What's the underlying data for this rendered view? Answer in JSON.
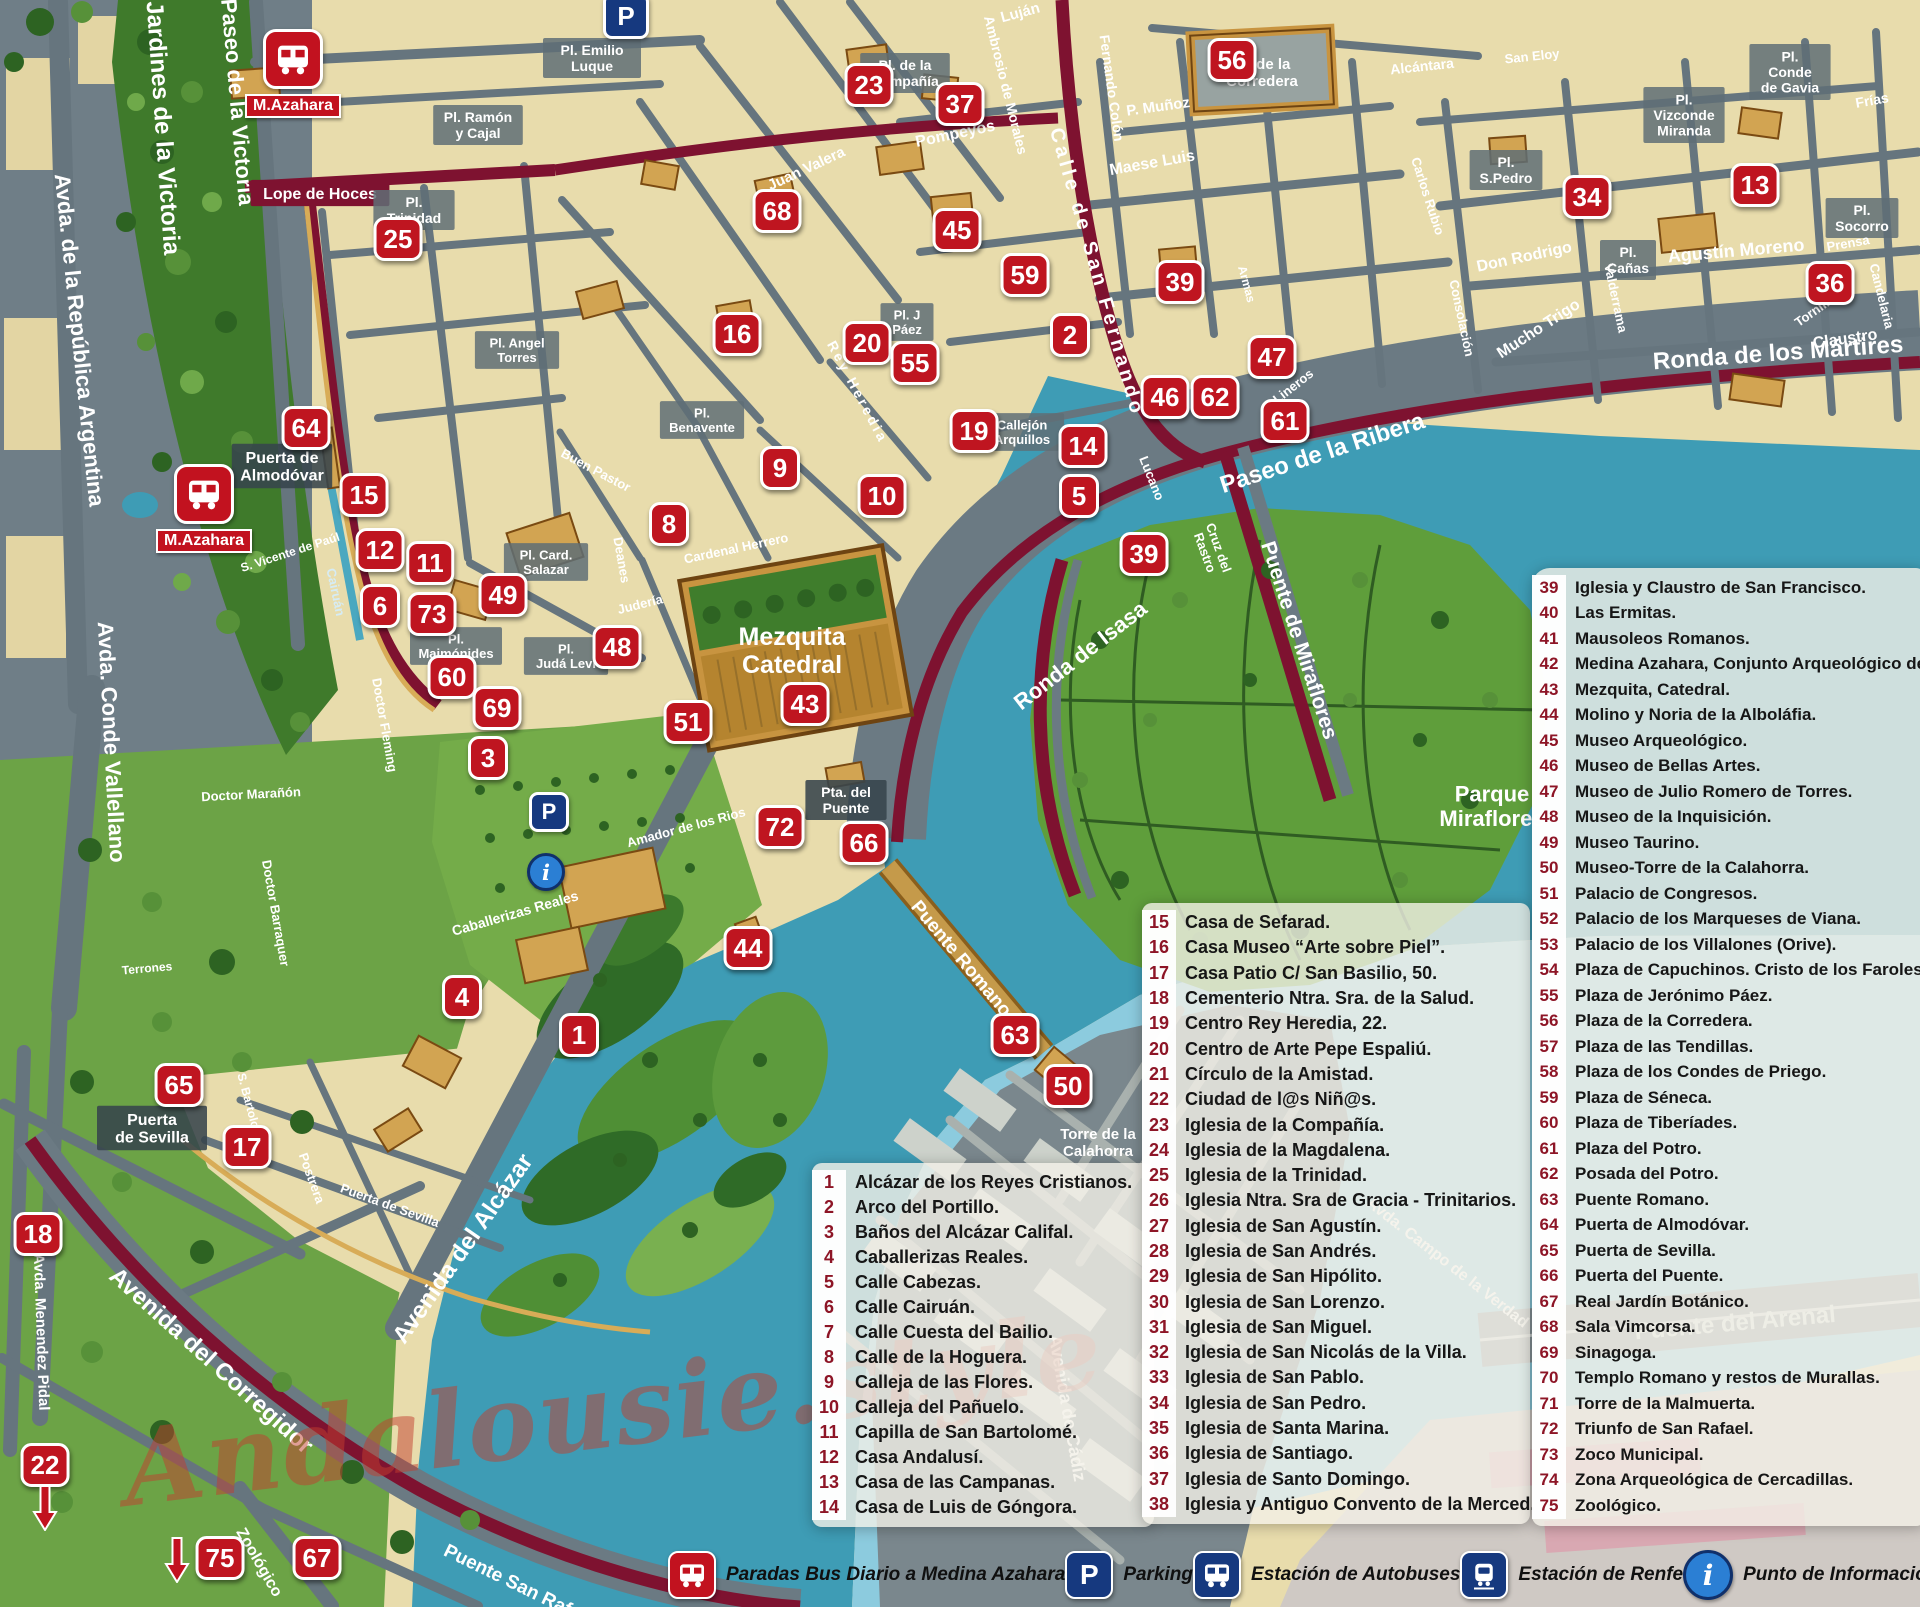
{
  "watermark": "Andalousie.style",
  "colors": {
    "marker_red": "#BF1520",
    "route_maroon": "#7E1230",
    "water": "#3E9CB5",
    "park_green": "#5F9E3B",
    "road_gray": "#66757E",
    "old_town_cream": "#E8DCAC",
    "legend_number": "#8D1526",
    "key_blue": "#16397F"
  },
  "legend1": {
    "items": [
      {
        "n": "1",
        "t": "Alcázar de los Reyes Cristianos."
      },
      {
        "n": "2",
        "t": "Arco del Portillo."
      },
      {
        "n": "3",
        "t": "Baños del Alcázar Califal."
      },
      {
        "n": "4",
        "t": "Caballerizas Reales."
      },
      {
        "n": "5",
        "t": "Calle Cabezas."
      },
      {
        "n": "6",
        "t": "Calle Cairuán."
      },
      {
        "n": "7",
        "t": "Calle Cuesta del Bailio."
      },
      {
        "n": "8",
        "t": "Calle de la Hoguera."
      },
      {
        "n": "9",
        "t": "Calleja de las Flores."
      },
      {
        "n": "10",
        "t": "Calleja del Pañuelo."
      },
      {
        "n": "11",
        "t": "Capilla de San Bartolomé."
      },
      {
        "n": "12",
        "t": "Casa Andalusí."
      },
      {
        "n": "13",
        "t": "Casa de las Campanas."
      },
      {
        "n": "14",
        "t": "Casa de Luis de Góngora."
      }
    ]
  },
  "legend2": {
    "items": [
      {
        "n": "15",
        "t": "Casa de Sefarad."
      },
      {
        "n": "16",
        "t": "Casa Museo “Arte sobre Piel”."
      },
      {
        "n": "17",
        "t": "Casa Patio C/ San Basilio, 50."
      },
      {
        "n": "18",
        "t": "Cementerio Ntra. Sra. de la Salud."
      },
      {
        "n": "19",
        "t": "Centro Rey Heredia, 22."
      },
      {
        "n": "20",
        "t": "Centro de Arte Pepe Espaliú."
      },
      {
        "n": "21",
        "t": "Círculo de la Amistad."
      },
      {
        "n": "22",
        "t": "Ciudad de l@s Niñ@s."
      },
      {
        "n": "23",
        "t": "Iglesia de la Compañía."
      },
      {
        "n": "24",
        "t": "Iglesia de la Magdalena."
      },
      {
        "n": "25",
        "t": "Iglesia de la Trinidad."
      },
      {
        "n": "26",
        "t": "Iglesia Ntra. Sra de Gracia - Trinitarios."
      },
      {
        "n": "27",
        "t": "Iglesia de San Agustín."
      },
      {
        "n": "28",
        "t": "Iglesia de San Andrés."
      },
      {
        "n": "29",
        "t": "Iglesia de San Hipólito."
      },
      {
        "n": "30",
        "t": "Iglesia de San Lorenzo."
      },
      {
        "n": "31",
        "t": "Iglesia de San Miguel."
      },
      {
        "n": "32",
        "t": "Iglesia de San Nicolás de la Villa."
      },
      {
        "n": "33",
        "t": "Iglesia de San Pablo."
      },
      {
        "n": "34",
        "t": "Iglesia de San Pedro."
      },
      {
        "n": "35",
        "t": "Iglesia de Santa Marina."
      },
      {
        "n": "36",
        "t": "Iglesia de Santiago."
      },
      {
        "n": "37",
        "t": "Iglesia de Santo Domingo."
      },
      {
        "n": "38",
        "t": "Iglesia y Antiguo Convento de la Merced."
      }
    ]
  },
  "legend3": {
    "items": [
      {
        "n": "39",
        "t": "Iglesia y Claustro de San Francisco."
      },
      {
        "n": "40",
        "t": "Las Ermitas."
      },
      {
        "n": "41",
        "t": "Mausoleos Romanos."
      },
      {
        "n": "42",
        "t": "Medina Azahara, Conjunto Arqueológico de."
      },
      {
        "n": "43",
        "t": "Mezquita, Catedral."
      },
      {
        "n": "44",
        "t": "Molino y Noria de la Alboláfia."
      },
      {
        "n": "45",
        "t": "Museo Arqueológico."
      },
      {
        "n": "46",
        "t": "Museo de Bellas Artes."
      },
      {
        "n": "47",
        "t": "Museo de Julio Romero de Torres."
      },
      {
        "n": "48",
        "t": "Museo de la Inquisición."
      },
      {
        "n": "49",
        "t": "Museo Taurino."
      },
      {
        "n": "50",
        "t": "Museo-Torre de la Calahorra."
      },
      {
        "n": "51",
        "t": "Palacio de Congresos."
      },
      {
        "n": "52",
        "t": "Palacio de los Marqueses de Viana."
      },
      {
        "n": "53",
        "t": "Palacio de los Villalones (Orive)."
      },
      {
        "n": "54",
        "t": "Plaza de Capuchinos. Cristo de los Faroles."
      },
      {
        "n": "55",
        "t": "Plaza de Jerónimo Páez."
      },
      {
        "n": "56",
        "t": "Plaza de la Corredera."
      },
      {
        "n": "57",
        "t": "Plaza de las Tendillas."
      },
      {
        "n": "58",
        "t": "Plaza de los Condes de Priego."
      },
      {
        "n": "59",
        "t": "Plaza de Séneca."
      },
      {
        "n": "60",
        "t": "Plaza de Tiberíades."
      },
      {
        "n": "61",
        "t": "Plaza del Potro."
      },
      {
        "n": "62",
        "t": "Posada del Potro."
      },
      {
        "n": "63",
        "t": "Puente Romano."
      },
      {
        "n": "64",
        "t": "Puerta de Almodóvar."
      },
      {
        "n": "65",
        "t": "Puerta de Sevilla."
      },
      {
        "n": "66",
        "t": "Puerta del Puente."
      },
      {
        "n": "67",
        "t": "Real Jardín Botánico."
      },
      {
        "n": "68",
        "t": "Sala Vimcorsa."
      },
      {
        "n": "69",
        "t": "Sinagoga."
      },
      {
        "n": "70",
        "t": "Templo Romano y restos de Murallas."
      },
      {
        "n": "71",
        "t": "Torre de la Malmuerta."
      },
      {
        "n": "72",
        "t": "Triunfo de San Rafael."
      },
      {
        "n": "73",
        "t": "Zoco Municipal."
      },
      {
        "n": "74",
        "t": "Zona Arqueológica de Cercadillas."
      },
      {
        "n": "75",
        "t": "Zoológico."
      }
    ]
  },
  "map_key": {
    "items": [
      {
        "icon": "bus-red",
        "label": "Paradas Bus Diario a Medina Azahara"
      },
      {
        "icon": "parking",
        "label": "Parking"
      },
      {
        "icon": "bus-blue",
        "label": "Estación de Autobuses"
      },
      {
        "icon": "train",
        "label": "Estación de Renfe"
      },
      {
        "icon": "info",
        "label": "Punto de Información Turística"
      }
    ]
  },
  "bus_stops": [
    {
      "x": 293,
      "y": 57,
      "label": "M.Azahara"
    },
    {
      "x": 204,
      "y": 492,
      "label": "M.Azahara"
    }
  ],
  "parking_points": [
    {
      "x": 626,
      "y": 16,
      "size": 40
    },
    {
      "x": 549,
      "y": 812,
      "size": 34
    }
  ],
  "info_points": [
    {
      "x": 546,
      "y": 872,
      "size": 32
    }
  ],
  "arrows": [
    {
      "x": 177,
      "y": 1560
    },
    {
      "x": 45,
      "y": 1508
    }
  ],
  "markers": [
    {
      "n": "23",
      "x": 869,
      "y": 85
    },
    {
      "n": "37",
      "x": 960,
      "y": 104
    },
    {
      "n": "56",
      "x": 1232,
      "y": 60
    },
    {
      "n": "34",
      "x": 1587,
      "y": 197
    },
    {
      "n": "13",
      "x": 1755,
      "y": 185
    },
    {
      "n": "36",
      "x": 1830,
      "y": 283
    },
    {
      "n": "25",
      "x": 398,
      "y": 239
    },
    {
      "n": "68",
      "x": 777,
      "y": 211
    },
    {
      "n": "45",
      "x": 957,
      "y": 230
    },
    {
      "n": "59",
      "x": 1025,
      "y": 275
    },
    {
      "n": "39",
      "x": 1180,
      "y": 282
    },
    {
      "n": "16",
      "x": 737,
      "y": 334
    },
    {
      "n": "20",
      "x": 867,
      "y": 343
    },
    {
      "n": "55",
      "x": 915,
      "y": 363
    },
    {
      "n": "2",
      "x": 1070,
      "y": 335
    },
    {
      "n": "47",
      "x": 1272,
      "y": 357
    },
    {
      "n": "46",
      "x": 1165,
      "y": 397
    },
    {
      "n": "62",
      "x": 1215,
      "y": 397
    },
    {
      "n": "61",
      "x": 1285,
      "y": 421
    },
    {
      "n": "19",
      "x": 974,
      "y": 431
    },
    {
      "n": "14",
      "x": 1083,
      "y": 446
    },
    {
      "n": "64",
      "x": 306,
      "y": 428
    },
    {
      "n": "15",
      "x": 364,
      "y": 495
    },
    {
      "n": "9",
      "x": 780,
      "y": 468
    },
    {
      "n": "10",
      "x": 882,
      "y": 496
    },
    {
      "n": "5",
      "x": 1079,
      "y": 496
    },
    {
      "n": "8",
      "x": 669,
      "y": 524
    },
    {
      "n": "12",
      "x": 380,
      "y": 550
    },
    {
      "n": "11",
      "x": 430,
      "y": 563
    },
    {
      "n": "39",
      "x": 1144,
      "y": 554
    },
    {
      "n": "6",
      "x": 380,
      "y": 606
    },
    {
      "n": "73",
      "x": 432,
      "y": 614
    },
    {
      "n": "49",
      "x": 503,
      "y": 595
    },
    {
      "n": "48",
      "x": 617,
      "y": 647
    },
    {
      "n": "60",
      "x": 452,
      "y": 677
    },
    {
      "n": "69",
      "x": 497,
      "y": 708
    },
    {
      "n": "51",
      "x": 688,
      "y": 722
    },
    {
      "n": "43",
      "x": 805,
      "y": 704
    },
    {
      "n": "3",
      "x": 488,
      "y": 758
    },
    {
      "n": "72",
      "x": 780,
      "y": 827
    },
    {
      "n": "66",
      "x": 864,
      "y": 843
    },
    {
      "n": "44",
      "x": 748,
      "y": 948
    },
    {
      "n": "4",
      "x": 462,
      "y": 997
    },
    {
      "n": "1",
      "x": 579,
      "y": 1035
    },
    {
      "n": "63",
      "x": 1015,
      "y": 1035
    },
    {
      "n": "50",
      "x": 1068,
      "y": 1086
    },
    {
      "n": "65",
      "x": 179,
      "y": 1085
    },
    {
      "n": "17",
      "x": 247,
      "y": 1147
    },
    {
      "n": "18",
      "x": 38,
      "y": 1234
    },
    {
      "n": "22",
      "x": 45,
      "y": 1465
    },
    {
      "n": "75",
      "x": 220,
      "y": 1558
    },
    {
      "n": "67",
      "x": 317,
      "y": 1558
    }
  ],
  "map_labels": [
    {
      "t": "Avda. de la República Argentina",
      "x": 80,
      "y": 340,
      "r": 84,
      "s": 22
    },
    {
      "t": "Jardines de la Victoria",
      "x": 164,
      "y": 128,
      "r": 86,
      "s": 24
    },
    {
      "t": "Paseo de la Victoria",
      "x": 238,
      "y": 102,
      "r": 85,
      "s": 22
    },
    {
      "t": "Avda. Conde Vallellano",
      "x": 112,
      "y": 742,
      "r": 87,
      "s": 22
    },
    {
      "t": "Avda. Menendez Pidal",
      "x": 42,
      "y": 1332,
      "r": 88,
      "s": 15
    },
    {
      "t": "Avenida del Alcázar",
      "x": 462,
      "y": 1248,
      "r": -55,
      "s": 24
    },
    {
      "t": "Avenida del Corregidor",
      "x": 212,
      "y": 1360,
      "r": 42,
      "s": 24
    },
    {
      "t": "Ronda de los Mártires",
      "x": 1778,
      "y": 352,
      "r": -4,
      "s": 24
    },
    {
      "t": "Paseo de la Ribera",
      "x": 1322,
      "y": 452,
      "r": -18,
      "s": 24
    },
    {
      "t": "Ronda de Isasa",
      "x": 1080,
      "y": 655,
      "r": -38,
      "s": 22
    },
    {
      "t": "Puente de Miraflores",
      "x": 1300,
      "y": 640,
      "r": 72,
      "s": 21
    },
    {
      "t": "Puente Romano",
      "x": 962,
      "y": 958,
      "r": 50,
      "s": 19
    },
    {
      "t": "Torre de la\nCalahorra",
      "x": 1098,
      "y": 1142,
      "s": 15
    },
    {
      "t": "Parque\nMiraflores",
      "x": 1492,
      "y": 806,
      "s": 22
    },
    {
      "t": "Puente del Arenal",
      "x": 1735,
      "y": 1322,
      "r": -5,
      "s": 24,
      "c": "#DDE3E1"
    },
    {
      "t": "Avda. Campo de la Verdad",
      "x": 1448,
      "y": 1262,
      "r": 38,
      "s": 16
    },
    {
      "t": "Avenida de Cádiz",
      "x": 1068,
      "y": 1408,
      "r": 80,
      "s": 18
    },
    {
      "t": "Zoológico",
      "x": 260,
      "y": 1562,
      "r": 60,
      "s": 16
    },
    {
      "t": "Puente San Rafael",
      "x": 520,
      "y": 1585,
      "r": 26,
      "s": 19
    },
    {
      "t": "Mezquita\nCatedral",
      "x": 792,
      "y": 650,
      "s": 25
    },
    {
      "t": "Pta. del\nPuente",
      "x": 846,
      "y": 800,
      "s": 14,
      "b": "dark"
    },
    {
      "t": "Puerta de\nAlmodóvar",
      "x": 282,
      "y": 466,
      "s": 16,
      "b": "dark"
    },
    {
      "t": "Puerta\nde Sevilla",
      "x": 152,
      "y": 1128,
      "s": 16,
      "b": "dark"
    },
    {
      "t": "Lope de Hoces",
      "x": 320,
      "y": 193,
      "s": 16,
      "b": "maroon"
    },
    {
      "t": "Pl.\nTrinidad",
      "x": 414,
      "y": 210,
      "s": 14,
      "b": "plaza"
    },
    {
      "t": "Pl. Ramón\ny Cajal",
      "x": 478,
      "y": 125,
      "s": 14,
      "b": "plaza"
    },
    {
      "t": "Pl. Emilio\nLuque",
      "x": 592,
      "y": 58,
      "s": 14,
      "b": "plaza"
    },
    {
      "t": "Pl. de la\nCompañía",
      "x": 905,
      "y": 73,
      "s": 14,
      "b": "plaza"
    },
    {
      "t": "Pl. de la\nCorredera",
      "x": 1262,
      "y": 72,
      "s": 15
    },
    {
      "t": "Pl.\nS.Pedro",
      "x": 1506,
      "y": 170,
      "s": 14,
      "b": "plaza"
    },
    {
      "t": "Pl.\nVizconde\nMiranda",
      "x": 1684,
      "y": 115,
      "s": 14,
      "b": "plaza"
    },
    {
      "t": "Pl.\nConde\nde Gavia",
      "x": 1790,
      "y": 72,
      "s": 14,
      "b": "plaza"
    },
    {
      "t": "Pl.\nSocorro",
      "x": 1862,
      "y": 218,
      "s": 14,
      "b": "plaza"
    },
    {
      "t": "Pl.\nCañas",
      "x": 1628,
      "y": 260,
      "s": 14,
      "b": "plaza"
    },
    {
      "t": "Agustín Moreno",
      "x": 1736,
      "y": 250,
      "r": -5,
      "s": 18
    },
    {
      "t": "Claustro",
      "x": 1845,
      "y": 338,
      "r": -8,
      "s": 16
    },
    {
      "t": "Don Rodrigo",
      "x": 1524,
      "y": 256,
      "r": -12,
      "s": 16
    },
    {
      "t": "Mucho Trigo",
      "x": 1538,
      "y": 328,
      "r": -33,
      "s": 16
    },
    {
      "t": "Maese Luis",
      "x": 1152,
      "y": 162,
      "r": -10,
      "s": 16
    },
    {
      "t": "P. Muñoz",
      "x": 1158,
      "y": 106,
      "r": -8,
      "s": 15
    },
    {
      "t": "Fernando Colón",
      "x": 1112,
      "y": 88,
      "r": 82,
      "s": 14
    },
    {
      "t": "Calle de San Fernando",
      "x": 1098,
      "y": 272,
      "r": 74,
      "s": 20,
      "ls": 4
    },
    {
      "t": "Ambrosio de Morales",
      "x": 1006,
      "y": 85,
      "r": 76,
      "s": 14
    },
    {
      "t": "Pompeyos",
      "x": 955,
      "y": 133,
      "r": -12,
      "s": 16
    },
    {
      "t": "Luján",
      "x": 1020,
      "y": 12,
      "r": -15,
      "s": 15
    },
    {
      "t": "Juan Valera",
      "x": 806,
      "y": 168,
      "r": -25,
      "s": 15
    },
    {
      "t": "Pl. J\nPáez",
      "x": 907,
      "y": 322,
      "s": 13,
      "b": "plaza"
    },
    {
      "t": "Pl. Angel\nTorres",
      "x": 517,
      "y": 350,
      "s": 13,
      "b": "plaza"
    },
    {
      "t": "Pl.\nBenavente",
      "x": 702,
      "y": 420,
      "s": 13,
      "b": "plaza"
    },
    {
      "t": "Pl. Card.\nSalazar",
      "x": 546,
      "y": 562,
      "s": 13,
      "b": "plaza"
    },
    {
      "t": "Pl.\nMaimónides",
      "x": 456,
      "y": 646,
      "s": 13,
      "b": "plaza"
    },
    {
      "t": "Pl.\nJudá Leví",
      "x": 566,
      "y": 656,
      "s": 13,
      "b": "plaza"
    },
    {
      "t": "Cardenal Herrero",
      "x": 736,
      "y": 548,
      "r": -12,
      "s": 13
    },
    {
      "t": "Judería",
      "x": 640,
      "y": 604,
      "r": -14,
      "s": 13
    },
    {
      "t": "Deanes",
      "x": 622,
      "y": 560,
      "r": 80,
      "s": 13
    },
    {
      "t": "Buen Pastor",
      "x": 596,
      "y": 470,
      "r": 28,
      "s": 13
    },
    {
      "t": "Rey Heredia",
      "x": 858,
      "y": 392,
      "r": 62,
      "s": 14,
      "ls": 3
    },
    {
      "t": "Cruz del\nRastro",
      "x": 1212,
      "y": 550,
      "r": 70,
      "s": 13
    },
    {
      "t": "Callejón\nArquillos",
      "x": 1022,
      "y": 432,
      "s": 13,
      "b": "plaza"
    },
    {
      "t": "Lucano",
      "x": 1152,
      "y": 478,
      "r": 68,
      "s": 13
    },
    {
      "t": "Frías",
      "x": 1872,
      "y": 100,
      "r": -10,
      "s": 14
    },
    {
      "t": "Alcántara",
      "x": 1422,
      "y": 66,
      "r": -6,
      "s": 14
    },
    {
      "t": "San Eloy",
      "x": 1532,
      "y": 56,
      "r": -6,
      "s": 13
    },
    {
      "t": "Prensa",
      "x": 1848,
      "y": 243,
      "r": -10,
      "s": 13
    },
    {
      "t": "Tornillo",
      "x": 1815,
      "y": 310,
      "r": -35,
      "s": 13
    },
    {
      "t": "Candelaria",
      "x": 1882,
      "y": 296,
      "r": 76,
      "s": 13
    },
    {
      "t": "Consolación",
      "x": 1462,
      "y": 318,
      "r": 78,
      "s": 13
    },
    {
      "t": "Carlos Rubio",
      "x": 1428,
      "y": 196,
      "r": 72,
      "s": 13
    },
    {
      "t": "Valderrama",
      "x": 1616,
      "y": 298,
      "r": 78,
      "s": 13
    },
    {
      "t": "Lineros",
      "x": 1293,
      "y": 386,
      "r": -38,
      "s": 13
    },
    {
      "t": "Armas",
      "x": 1247,
      "y": 284,
      "r": 75,
      "s": 12
    },
    {
      "t": "S. Vicente de Paúl",
      "x": 290,
      "y": 552,
      "r": -18,
      "s": 12
    },
    {
      "t": "Cairuán",
      "x": 336,
      "y": 592,
      "r": 78,
      "s": 13,
      "c": "#D6ECF5"
    },
    {
      "t": "Doctor Fleming",
      "x": 385,
      "y": 725,
      "r": 80,
      "s": 13
    },
    {
      "t": "Doctor Marañón",
      "x": 251,
      "y": 794,
      "r": -3,
      "s": 13
    },
    {
      "t": "Doctor Barraquer",
      "x": 276,
      "y": 913,
      "r": 80,
      "s": 13
    },
    {
      "t": "Terrones",
      "x": 147,
      "y": 968,
      "r": -5,
      "s": 12
    },
    {
      "t": "Caballerizas Reales",
      "x": 515,
      "y": 913,
      "r": -16,
      "s": 14
    },
    {
      "t": "Amador de los Rios",
      "x": 686,
      "y": 827,
      "r": -15,
      "s": 13
    },
    {
      "t": "S. Bartolomé",
      "x": 251,
      "y": 1109,
      "r": 75,
      "s": 12
    },
    {
      "t": "Postrera",
      "x": 312,
      "y": 1178,
      "r": 70,
      "s": 13
    },
    {
      "t": "Puerta de Sevilla",
      "x": 390,
      "y": 1205,
      "r": 20,
      "s": 13
    }
  ]
}
